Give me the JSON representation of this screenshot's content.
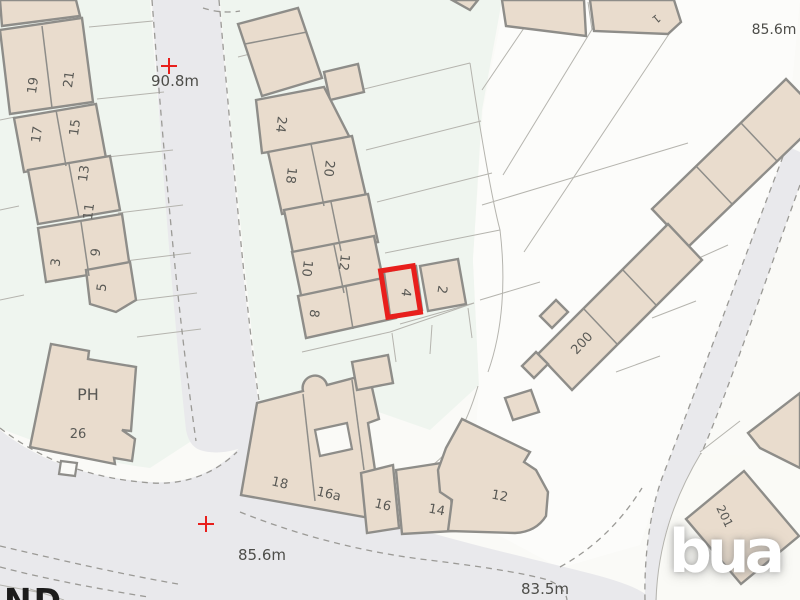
{
  "map": {
    "watermark": {
      "text": "bua"
    },
    "partial_street_text": "ND",
    "colors": {
      "building": "#e9dccd",
      "building_outline": "#8e8d89",
      "road": "#e9e9ec",
      "plot_tint": "#eff5ef",
      "label_text": "#595955",
      "benchmark_text": "#4d4d49",
      "highlight_red": "#e81f1c",
      "watermark_white": "#ffffff"
    },
    "highlight": {
      "plot": "4",
      "x": 384,
      "y": 268,
      "w": 33,
      "h": 47,
      "rot": -9,
      "stroke_width": 5
    },
    "labels": [
      {
        "text": "19",
        "x": 37,
        "y": 86,
        "rot": -82,
        "size": 13
      },
      {
        "text": "21",
        "x": 73,
        "y": 80,
        "rot": -82,
        "size": 13
      },
      {
        "text": "17",
        "x": 41,
        "y": 135,
        "rot": -82,
        "size": 13
      },
      {
        "text": "15",
        "x": 79,
        "y": 128,
        "rot": -82,
        "size": 13
      },
      {
        "text": "13",
        "x": 88,
        "y": 174,
        "rot": -82,
        "size": 13
      },
      {
        "text": "11",
        "x": 93,
        "y": 212,
        "rot": -82,
        "size": 13
      },
      {
        "text": "3",
        "x": 60,
        "y": 263,
        "rot": -82,
        "size": 13
      },
      {
        "text": "9",
        "x": 100,
        "y": 253,
        "rot": -82,
        "size": 13
      },
      {
        "text": "5",
        "x": 106,
        "y": 288,
        "rot": -82,
        "size": 13
      },
      {
        "text": "24",
        "x": 277,
        "y": 124,
        "rot": 97,
        "size": 13
      },
      {
        "text": "20",
        "x": 325,
        "y": 168,
        "rot": 97,
        "size": 13
      },
      {
        "text": "18",
        "x": 287,
        "y": 175,
        "rot": 97,
        "size": 13
      },
      {
        "text": "10",
        "x": 303,
        "y": 268,
        "rot": 97,
        "size": 13
      },
      {
        "text": "12",
        "x": 340,
        "y": 262,
        "rot": 97,
        "size": 13
      },
      {
        "text": "8",
        "x": 310,
        "y": 313,
        "rot": 97,
        "size": 13
      },
      {
        "text": "4",
        "x": 402,
        "y": 292,
        "rot": 99,
        "size": 13
      },
      {
        "text": "2",
        "x": 438,
        "y": 289,
        "rot": 99,
        "size": 13
      },
      {
        "text": "1",
        "x": 654,
        "y": 16,
        "rot": 140,
        "size": 11
      },
      {
        "text": "200",
        "x": 585,
        "y": 346,
        "rot": -47,
        "size": 13
      },
      {
        "text": "201",
        "x": 721,
        "y": 518,
        "rot": 64,
        "size": 12
      },
      {
        "text": "PH",
        "x": 88,
        "y": 400,
        "rot": 0,
        "size": 16,
        "name": "ph-label"
      },
      {
        "text": "26",
        "x": 78,
        "y": 438,
        "rot": 0,
        "size": 13
      },
      {
        "text": "18",
        "x": 279,
        "y": 487,
        "rot": 13,
        "size": 13
      },
      {
        "text": "16a",
        "x": 328,
        "y": 498,
        "rot": 13,
        "size": 13
      },
      {
        "text": "16",
        "x": 382,
        "y": 509,
        "rot": 13,
        "size": 13
      },
      {
        "text": "14",
        "x": 436,
        "y": 514,
        "rot": 11,
        "size": 13
      },
      {
        "text": "12",
        "x": 499,
        "y": 500,
        "rot": 11,
        "size": 13
      }
    ],
    "benchmarks": [
      {
        "text": "90.8m",
        "tx": 175,
        "ty": 86,
        "size": 15,
        "cross": {
          "x": 169,
          "y": 66
        }
      },
      {
        "text": "85.6m",
        "tx": 774,
        "ty": 34,
        "size": 14
      },
      {
        "text": "85.6m",
        "tx": 262,
        "ty": 560,
        "size": 15,
        "cross": {
          "x": 206,
          "y": 524
        }
      },
      {
        "text": "83.5m",
        "tx": 545,
        "ty": 594,
        "size": 15
      }
    ]
  }
}
